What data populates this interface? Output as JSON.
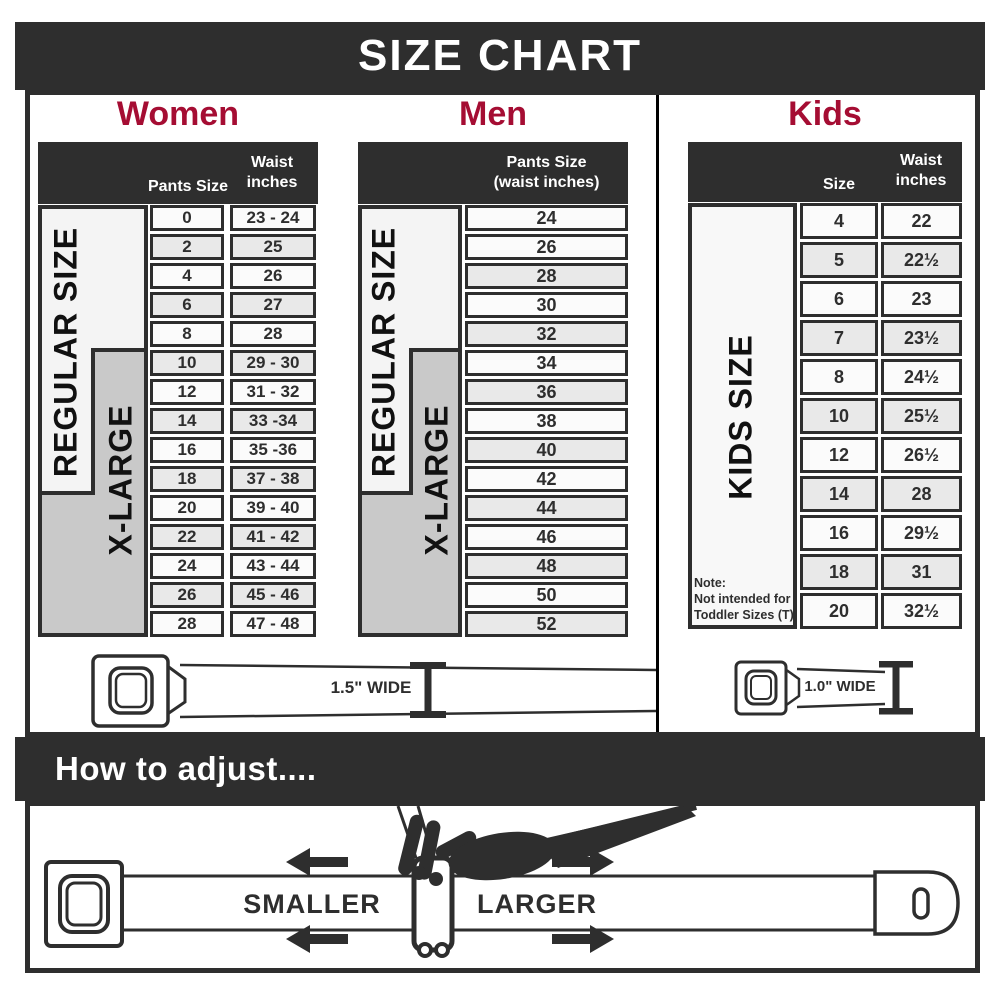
{
  "title": "SIZE CHART",
  "women": {
    "heading": "Women",
    "col_size": "Pants Size",
    "col_waist_l1": "Waist",
    "col_waist_l2": "inches",
    "band_regular": "REGULAR SIZE",
    "band_xlarge": "X-LARGE",
    "rows": [
      {
        "size": "0",
        "waist": "23 - 24"
      },
      {
        "size": "2",
        "waist": "25"
      },
      {
        "size": "4",
        "waist": "26"
      },
      {
        "size": "6",
        "waist": "27"
      },
      {
        "size": "8",
        "waist": "28"
      },
      {
        "size": "10",
        "waist": "29 - 30"
      },
      {
        "size": "12",
        "waist": "31 - 32"
      },
      {
        "size": "14",
        "waist": "33 -34"
      },
      {
        "size": "16",
        "waist": "35 -36"
      },
      {
        "size": "18",
        "waist": "37 - 38"
      },
      {
        "size": "20",
        "waist": "39 - 40"
      },
      {
        "size": "22",
        "waist": "41 - 42"
      },
      {
        "size": "24",
        "waist": "43 - 44"
      },
      {
        "size": "26",
        "waist": "45 - 46"
      },
      {
        "size": "28",
        "waist": "47 - 48"
      }
    ]
  },
  "men": {
    "heading": "Men",
    "col_l1": "Pants Size",
    "col_l2": "(waist inches)",
    "band_regular": "REGULAR SIZE",
    "band_xlarge": "X-LARGE",
    "rows": [
      "24",
      "26",
      "28",
      "30",
      "32",
      "34",
      "36",
      "38",
      "40",
      "42",
      "44",
      "46",
      "48",
      "50",
      "52"
    ]
  },
  "kids": {
    "heading": "Kids",
    "col_size": "Size",
    "col_waist_l1": "Waist",
    "col_waist_l2": "inches",
    "band": "KIDS SIZE",
    "note_l1": "Note:",
    "note_l2": "Not intended for",
    "note_l3": "Toddler Sizes (T)",
    "rows": [
      {
        "size": "4",
        "waist": "22"
      },
      {
        "size": "5",
        "waist": "22½"
      },
      {
        "size": "6",
        "waist": "23"
      },
      {
        "size": "7",
        "waist": "23½"
      },
      {
        "size": "8",
        "waist": "24½"
      },
      {
        "size": "10",
        "waist": "25½"
      },
      {
        "size": "12",
        "waist": "26½"
      },
      {
        "size": "14",
        "waist": "28"
      },
      {
        "size": "16",
        "waist": "29½"
      },
      {
        "size": "18",
        "waist": "31"
      },
      {
        "size": "20",
        "waist": "32½"
      }
    ]
  },
  "belts": {
    "adult_width": "1.5\" WIDE",
    "kids_width": "1.0\" WIDE"
  },
  "adjust": {
    "heading": "How to adjust....",
    "smaller": "SMALLER",
    "larger": "LARGER"
  },
  "colors": {
    "accent": "#a50d33",
    "dark": "#2e2e2e",
    "band_gray": "#c9c9c9",
    "row_gray": "#e9e9e9"
  }
}
